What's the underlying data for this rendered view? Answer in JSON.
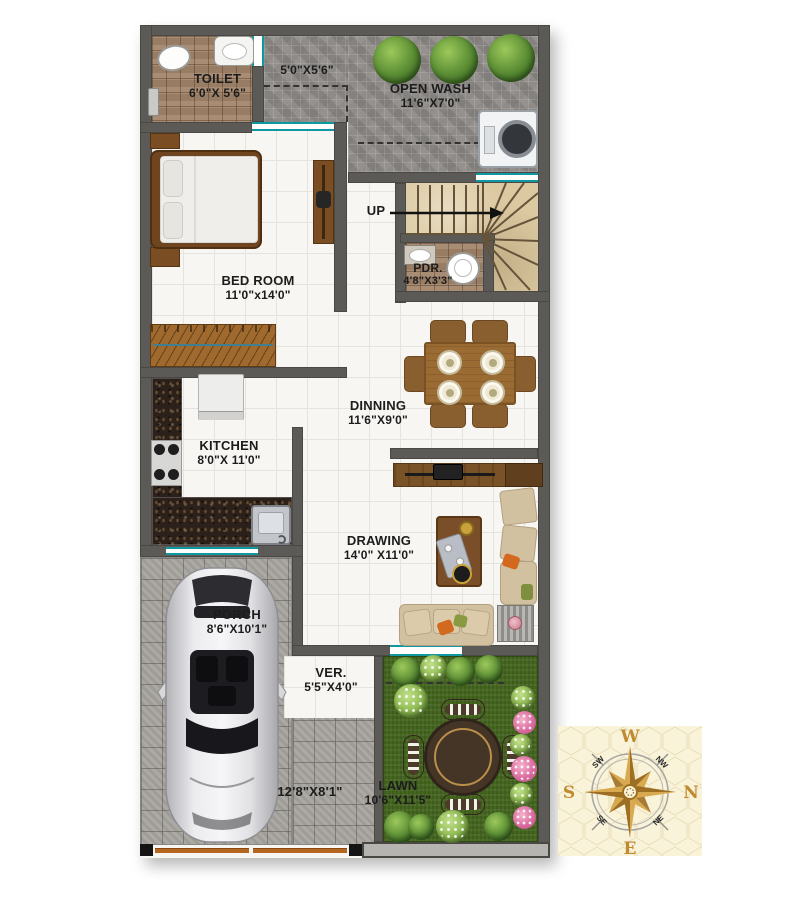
{
  "rooms": {
    "toilet": {
      "label": "TOILET",
      "dims": "6'0\"X 5'6\""
    },
    "passage": {
      "dims": "5'0\"X5'6\""
    },
    "open_wash": {
      "label": "OPEN WASH",
      "dims": "11'6\"X7'0\""
    },
    "bedroom": {
      "label": "BED ROOM",
      "dims": "11'0\"x14'0\""
    },
    "stairs": {
      "label": "UP"
    },
    "pdr": {
      "label": "PDR.",
      "dims": "4'8\"X3'3\""
    },
    "dining": {
      "label": "DINNING",
      "dims": "11'6\"X9'0\""
    },
    "kitchen": {
      "label": "KITCHEN",
      "dims": "8'0\"X 11'0\""
    },
    "drawing": {
      "label": "DRAWING",
      "dims": "14'0\" X11'0\""
    },
    "porch": {
      "label": "PORCH",
      "dims": "8'6\"X10'1\""
    },
    "verandah": {
      "label": "VER.",
      "dims": "5'5\"X4'0\""
    },
    "lawn": {
      "label": "LAWN",
      "dims": "10'6\"X11'5\""
    },
    "plot_front": {
      "dims": "12'8\"X8'1\""
    }
  },
  "compass": {
    "w": "W",
    "n": "N",
    "e": "E",
    "s": "S",
    "nw": "NW",
    "ne": "NE",
    "se": "SE",
    "sw": "SW"
  },
  "colors": {
    "wall": "#5c5a57",
    "window_accent": "#0f98a0",
    "floor_tile": "#f7f6f2",
    "bath_tile": "#a1846a",
    "mosaic_tile": "#8e8b88",
    "stairs": "#dcc9a1",
    "granite": "#2b211a",
    "paver": "#a7a49e",
    "lawn": "#45661f",
    "compass_bg": "#f9f3da",
    "compass_gold": "#c08a30"
  }
}
